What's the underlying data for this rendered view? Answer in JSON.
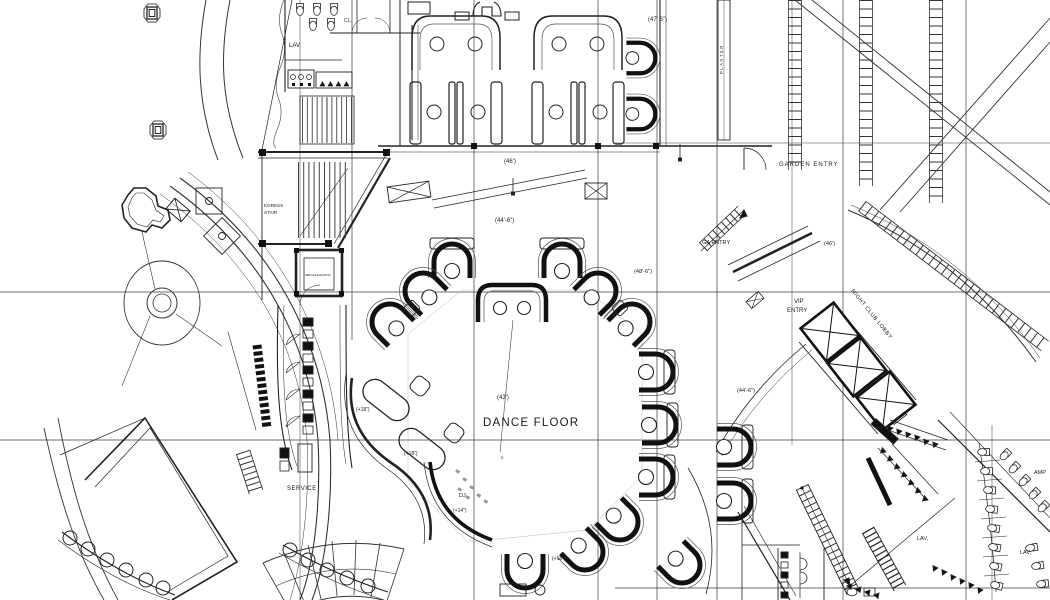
{
  "plan": {
    "rooms": {
      "lav_top": "LAV.",
      "cl": "CL.",
      "egress1": "EGRESS",
      "egress2": "STAIR",
      "service_elevator": "SERVICE ELEVATOR",
      "planter": "PLANTER",
      "garden_entry": "GARDEN  ENTRY",
      "ga_entry": "GA ENTRY",
      "vip1": "VIP",
      "vip2": "ENTRY",
      "night_club_lobby": "NIGHT CLUB LOBBY",
      "dance_floor": "DANCE FLOOR",
      "dj": "DJ",
      "service": "SERVICE",
      "lav_b1": "LAV,",
      "lav_b2": "LAV,",
      "amp": "AMP"
    },
    "dims": {
      "d47": "(47' 6\")",
      "d46a": "(46')",
      "d44a": "(44'-6\")",
      "d48": "(48'-6\")",
      "d46b": "(46')",
      "d44b": "(44'-6\")",
      "d43": "(43')"
    },
    "levels": {
      "p18a": "(+18\")",
      "p18b": "(+18\")",
      "p18c": "(+18\")",
      "p14": "(+14\")"
    },
    "markers": {
      "e": "E"
    },
    "colors": {
      "line": "#1a1a1a",
      "background": "#ffffff"
    }
  }
}
